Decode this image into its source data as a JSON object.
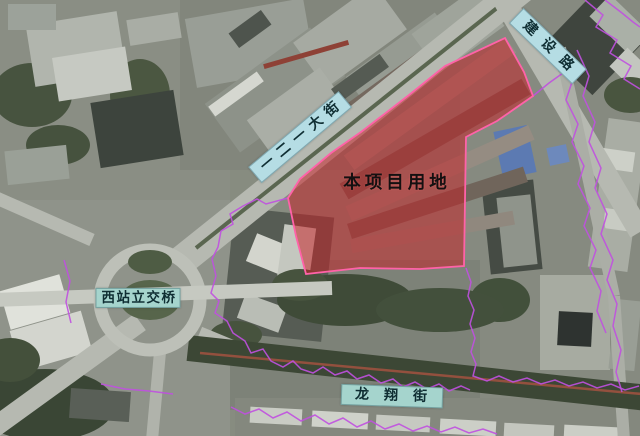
{
  "colors": {
    "site_fill": "#c51f24",
    "site_stroke": "#ff62a8",
    "parcel_stroke": "#c050e0",
    "label_bg_blue": "#b5dde4",
    "label_bg_teal": "#a5d4cd",
    "label_text": "#0f2e33",
    "site_label_text": "#141011"
  },
  "labels": {
    "main_street": "一二一大街",
    "jianshe_road": "建设路",
    "xizhan_overpass": "西站立交桥",
    "longxiang_street": "龙翔街",
    "site": "本项目用地"
  },
  "overlay": {
    "site_polygon": "505,38 524,72 533,96 497,121 466,137 465,200 464,266 420,269 360,268 306,274 296,236 288,198 300,179 331,153 361,132 409,95 445,66",
    "parcel_lines": {
      "left_loop": "288,198 266,204 257,199 243,206 230,214 233,224 221,231 218,247 212,259 216,276 211,293 219,301 215,313 227,321 233,333 245,341 251,353 263,349 271,361 283,367 293,361 301,369 313,373 323,367 335,375 347,371 357,379 369,375 381,383 393,379 403,387 415,382 427,389 439,384 449,391 461,386 470,390",
      "south_run": "466,268 471,282 468,296 474,310 470,324 475,338 471,352 476,364 473,376 487,381 499,376 513,382 527,378 541,384 555,380 569,386 583,382 597,388 611,384 625,390 639,386",
      "bottom_zigzag": "231,407 245,414 259,409 273,418 287,412 301,421 315,415 329,424 343,418 357,427 371,421 385,429 399,424 413,431 427,426 441,432 455,427 469,433 483,429 497,434",
      "east_road_a": "560,56 572,82 566,100 578,124 572,142 584,166 578,184 590,208 584,226 596,250 590,268 601,291 597,311 606,333",
      "east_road_b": "577,50 589,76 583,96 595,122 589,142 601,168 595,188 607,214 601,234 613,260 607,280 617,304 613,326 621,350 616,372 622,392",
      "northeast_a": "585,0 603,15 596,27 617,40 610,53 631,66 624,79 640,89",
      "northeast_b": "605,0 622,13 633,22 640,27",
      "corner_link": "533,96 549,83 563,73",
      "west_segment": "64,260 70,281 66,302 71,323",
      "southwest_segment": "101,384 125,389 149,391 173,394"
    }
  }
}
